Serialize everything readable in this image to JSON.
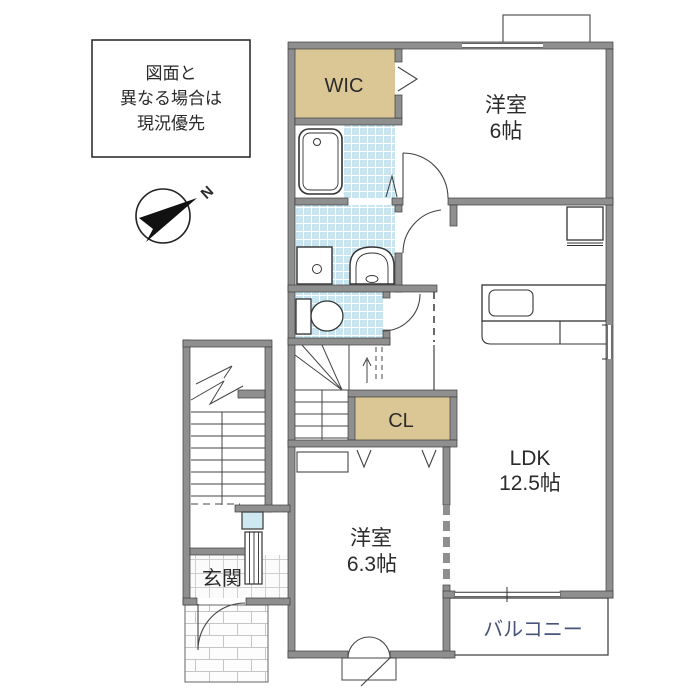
{
  "disclaimer": {
    "line1": "図面と",
    "line2": "異なる場合は",
    "line3": "現況優先"
  },
  "compass": {
    "label": "N"
  },
  "rooms": {
    "wic": {
      "label": "WIC"
    },
    "bedroom1": {
      "name": "洋室",
      "size": "6帖"
    },
    "ldk": {
      "name": "LDK",
      "size": "12.5帖"
    },
    "closet": {
      "label": "CL"
    },
    "bedroom2": {
      "name": "洋室",
      "size": "6.3帖"
    },
    "entrance": {
      "label": "玄関"
    },
    "balcony": {
      "label": "バルコニー"
    }
  },
  "colors": {
    "closet_beige": "#dbc795",
    "tile_blue": "#c9e5f0",
    "wall_gray": "#8f8f8f",
    "line_dark": "#3c3c3c",
    "balcony_text": "#47557a",
    "window_blue": "#cfe9f2"
  }
}
